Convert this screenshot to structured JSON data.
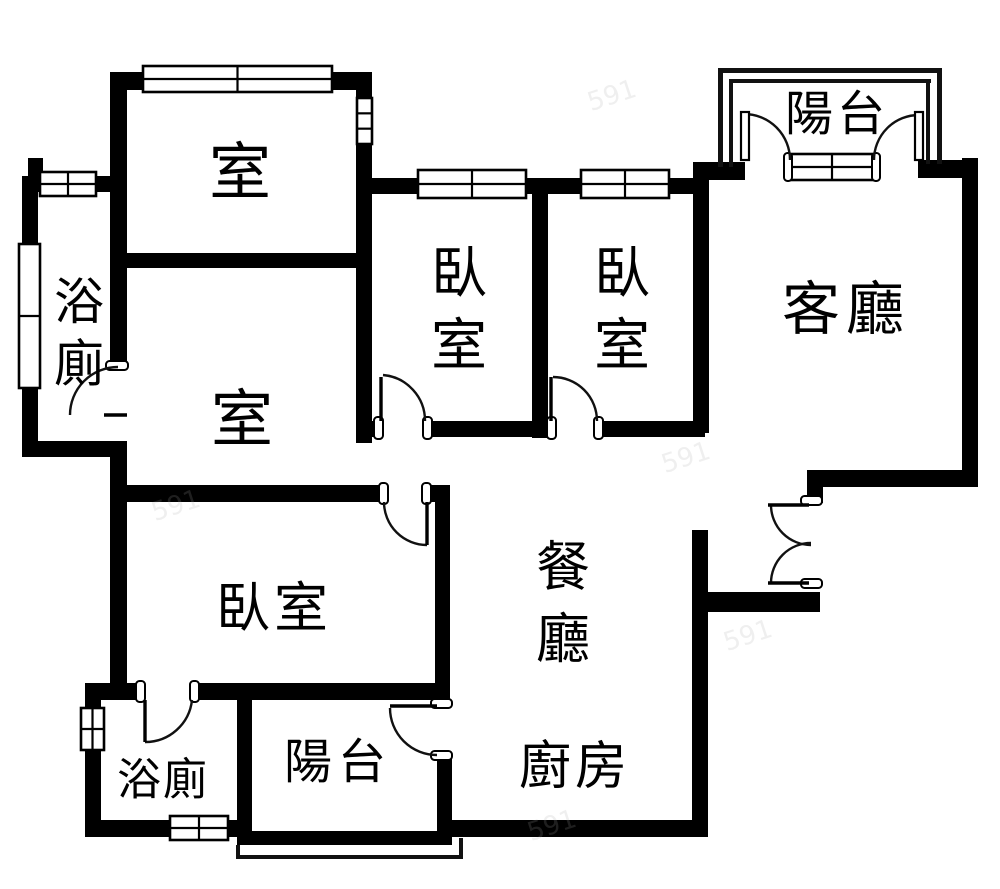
{
  "plan": {
    "colors": {
      "wall": "#000000",
      "line": "#111111",
      "background": "#ffffff",
      "watermark": "#aaaaaa"
    },
    "canvas": {
      "width": 1000,
      "height": 889
    },
    "labels": [
      {
        "name": "room-north-label",
        "text": "室",
        "x": 240,
        "y": 172,
        "size": 62,
        "dir": "h",
        "ls": 0
      },
      {
        "name": "bathroom-upper-label",
        "text": "浴廁",
        "x": 79,
        "y": 302,
        "size": 50,
        "dir": "v",
        "gap": 62
      },
      {
        "name": "bedroom-1-label",
        "text": "臥室",
        "x": 459,
        "y": 274,
        "size": 56,
        "dir": "v",
        "gap": 72
      },
      {
        "name": "bedroom-2-label",
        "text": "臥室",
        "x": 622,
        "y": 274,
        "size": 56,
        "dir": "v",
        "gap": 72
      },
      {
        "name": "living-room-label",
        "text": "客廳",
        "x": 846,
        "y": 309,
        "size": 58,
        "dir": "h",
        "ls": 6
      },
      {
        "name": "balcony-north-label",
        "text": "陽台",
        "x": 837,
        "y": 114,
        "size": 48,
        "dir": "h",
        "ls": 4
      },
      {
        "name": "room-middle-label",
        "text": "室",
        "x": 242,
        "y": 419,
        "size": 62,
        "dir": "h",
        "ls": 0
      },
      {
        "name": "bedroom-3-label",
        "text": "臥室",
        "x": 274,
        "y": 608,
        "size": 54,
        "dir": "h",
        "ls": 4
      },
      {
        "name": "dining-room-label",
        "text": "餐廳",
        "x": 563,
        "y": 567,
        "size": 54,
        "dir": "v",
        "gap": 72
      },
      {
        "name": "kitchen-label",
        "text": "廚房",
        "x": 575,
        "y": 767,
        "size": 52,
        "dir": "h",
        "ls": 4
      },
      {
        "name": "bathroom-lower-label",
        "text": "浴廁",
        "x": 163,
        "y": 780,
        "size": 44,
        "dir": "h",
        "ls": 2
      },
      {
        "name": "balcony-south-label",
        "text": "陽台",
        "x": 338,
        "y": 762,
        "size": 48,
        "dir": "h",
        "ls": 6
      }
    ],
    "walls": [
      [
        118,
        72,
        254,
        18
      ],
      [
        110,
        72,
        17,
        294
      ],
      [
        110,
        443,
        17,
        244
      ],
      [
        110,
        253,
        262,
        15
      ],
      [
        356,
        86,
        16,
        14
      ],
      [
        356,
        142,
        16,
        301
      ],
      [
        28,
        158,
        15,
        22
      ],
      [
        28,
        176,
        82,
        16
      ],
      [
        22,
        176,
        16,
        72
      ],
      [
        22,
        386,
        16,
        71
      ],
      [
        22,
        441,
        105,
        16
      ],
      [
        372,
        178,
        173,
        16
      ],
      [
        532,
        178,
        16,
        260
      ],
      [
        548,
        178,
        149,
        16
      ],
      [
        693,
        162,
        16,
        271
      ],
      [
        356,
        421,
        27,
        16
      ],
      [
        425,
        421,
        128,
        16
      ],
      [
        597,
        421,
        108,
        16
      ],
      [
        110,
        485,
        275,
        17
      ],
      [
        427,
        485,
        23,
        17
      ],
      [
        435,
        502,
        15,
        198
      ],
      [
        85,
        683,
        57,
        17
      ],
      [
        195,
        683,
        253,
        17
      ],
      [
        85,
        683,
        16,
        27
      ],
      [
        85,
        748,
        16,
        89
      ],
      [
        85,
        820,
        152,
        17
      ],
      [
        237,
        698,
        15,
        147
      ],
      [
        237,
        831,
        215,
        14
      ],
      [
        437,
        755,
        15,
        90
      ],
      [
        692,
        530,
        16,
        307
      ],
      [
        447,
        820,
        261,
        17
      ],
      [
        705,
        592,
        115,
        20
      ],
      [
        807,
        470,
        171,
        17
      ],
      [
        807,
        470,
        16,
        33
      ],
      [
        962,
        158,
        16,
        329
      ],
      [
        697,
        162,
        48,
        18
      ],
      [
        918,
        160,
        60,
        18
      ]
    ],
    "railings": [
      [
        718,
        68,
        224,
        5
      ],
      [
        718,
        68,
        5,
        99
      ],
      [
        937,
        68,
        5,
        96
      ],
      [
        729,
        79,
        202,
        4
      ],
      [
        729,
        79,
        4,
        88
      ],
      [
        926,
        79,
        4,
        85
      ],
      [
        236,
        845,
        4,
        14
      ],
      [
        236,
        855,
        227,
        4
      ],
      [
        459,
        838,
        4,
        21
      ]
    ],
    "windows": [
      {
        "x": 143,
        "y": 66,
        "w": 189,
        "h": 26,
        "cols": 2,
        "rows": 2
      },
      {
        "x": 357,
        "y": 98,
        "w": 15,
        "h": 46,
        "cols": 1,
        "rows": 3
      },
      {
        "x": 40,
        "y": 172,
        "w": 56,
        "h": 24,
        "cols": 2,
        "rows": 2
      },
      {
        "x": 19,
        "y": 244,
        "w": 21,
        "h": 144,
        "cols": 1,
        "rows": 2
      },
      {
        "x": 418,
        "y": 170,
        "w": 108,
        "h": 28,
        "cols": 2,
        "rows": 2
      },
      {
        "x": 581,
        "y": 170,
        "w": 88,
        "h": 28,
        "cols": 2,
        "rows": 2
      },
      {
        "x": 791,
        "y": 154,
        "w": 82,
        "h": 26,
        "cols": 2,
        "rows": 2
      },
      {
        "x": 81,
        "y": 708,
        "w": 23,
        "h": 42,
        "cols": 2,
        "rows": 2
      },
      {
        "x": 170,
        "y": 816,
        "w": 58,
        "h": 24,
        "cols": 2,
        "rows": 2
      }
    ],
    "jamb_caps": [
      [
        106,
        361,
        22,
        9
      ],
      [
        374,
        417,
        9,
        22
      ],
      [
        423,
        417,
        9,
        22
      ],
      [
        547,
        417,
        9,
        22
      ],
      [
        594,
        417,
        9,
        22
      ],
      [
        379,
        483,
        9,
        21
      ],
      [
        422,
        483,
        9,
        21
      ],
      [
        136,
        681,
        9,
        21
      ],
      [
        190,
        681,
        9,
        21
      ],
      [
        431,
        699,
        21,
        9
      ],
      [
        431,
        751,
        21,
        9
      ],
      [
        801,
        496,
        21,
        9
      ],
      [
        801,
        579,
        21,
        9
      ],
      [
        784,
        153,
        8,
        28
      ],
      [
        872,
        153,
        8,
        28
      ]
    ],
    "door_arcs": [
      "M 70 415 A 48 48 0 0 1 118 367",
      "M 383 375 A 46 46 0 0 1 425 421",
      "M 553 377 A 44 44 0 0 1 597 421",
      "M 384 502 A 43 43 0 0 0 427 545",
      "M 145 742 A 47 47 0 0 0 192 700",
      "M 390 708 A 47 47 0 0 0 437 755",
      "M 771 505 A 40 40 0 0 0 811 545",
      "M 771 583 A 40 40 0 0 1 811 543",
      "M 744 114 A 46 46 0 0 1 790 160",
      "M 919 115 A 45 45 0 0 0 874 160"
    ],
    "door_leaves": [
      [
        104,
        415,
        127,
        415
      ],
      [
        381,
        377,
        381,
        421
      ],
      [
        551,
        377,
        551,
        421
      ],
      [
        427,
        502,
        427,
        545
      ],
      [
        145,
        700,
        145,
        742
      ],
      [
        390,
        706,
        437,
        706
      ],
      [
        768,
        505,
        809,
        505
      ],
      [
        768,
        583,
        809,
        583
      ]
    ],
    "french_door_leaves": [
      [
        741,
        112,
        8,
        48
      ],
      [
        915,
        112,
        8,
        48
      ]
    ],
    "watermarks": [
      {
        "text": "591",
        "x": 612,
        "y": 96,
        "rot": -18,
        "size": 26
      },
      {
        "text": "591",
        "x": 176,
        "y": 506,
        "rot": -18,
        "size": 26
      },
      {
        "text": "591",
        "x": 686,
        "y": 458,
        "rot": -18,
        "size": 26
      },
      {
        "text": "591",
        "x": 748,
        "y": 636,
        "rot": -18,
        "size": 26
      },
      {
        "text": "591",
        "x": 552,
        "y": 826,
        "rot": -18,
        "size": 26
      }
    ]
  }
}
